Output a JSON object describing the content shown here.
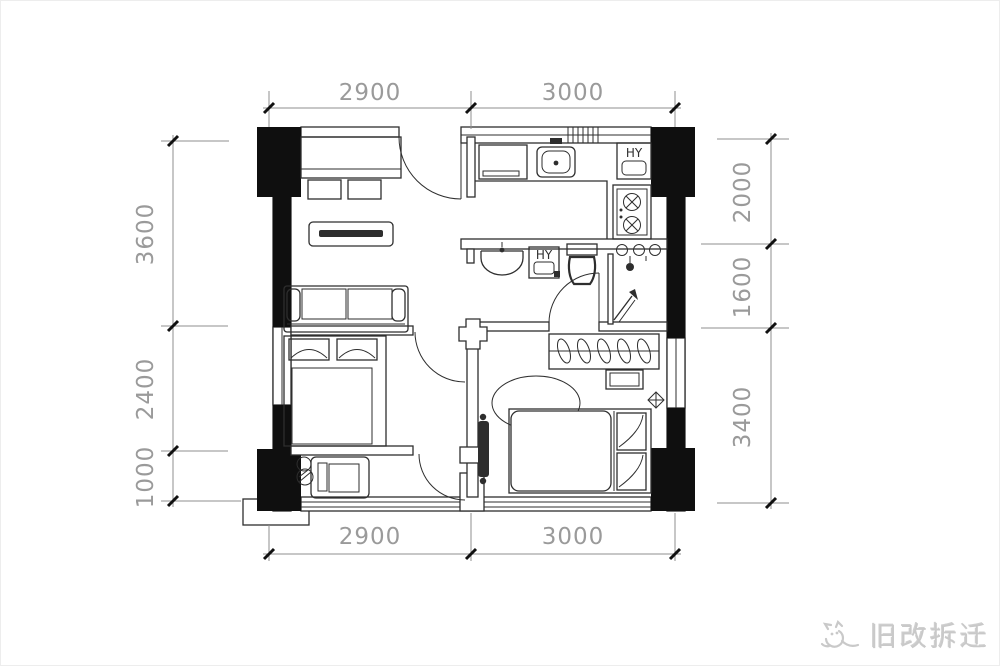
{
  "dimensions": {
    "top": [
      "2900",
      "3000"
    ],
    "bottom": [
      "2900",
      "3000"
    ],
    "left": [
      "3600",
      "2400",
      "1000"
    ],
    "right": [
      "2000",
      "1600",
      "3400"
    ]
  },
  "labels": {
    "kitchen_appliance": "HY",
    "bath_appliance": "HY"
  },
  "watermark": {
    "text": "旧改拆迁"
  },
  "colors": {
    "background": "#ffffff",
    "line": "#2e2e2e",
    "wall": "#0f0f0f",
    "dim_line": "#8f8f8f",
    "dim_text": "#9a9a9a",
    "watermark": "#c9c9c9"
  }
}
